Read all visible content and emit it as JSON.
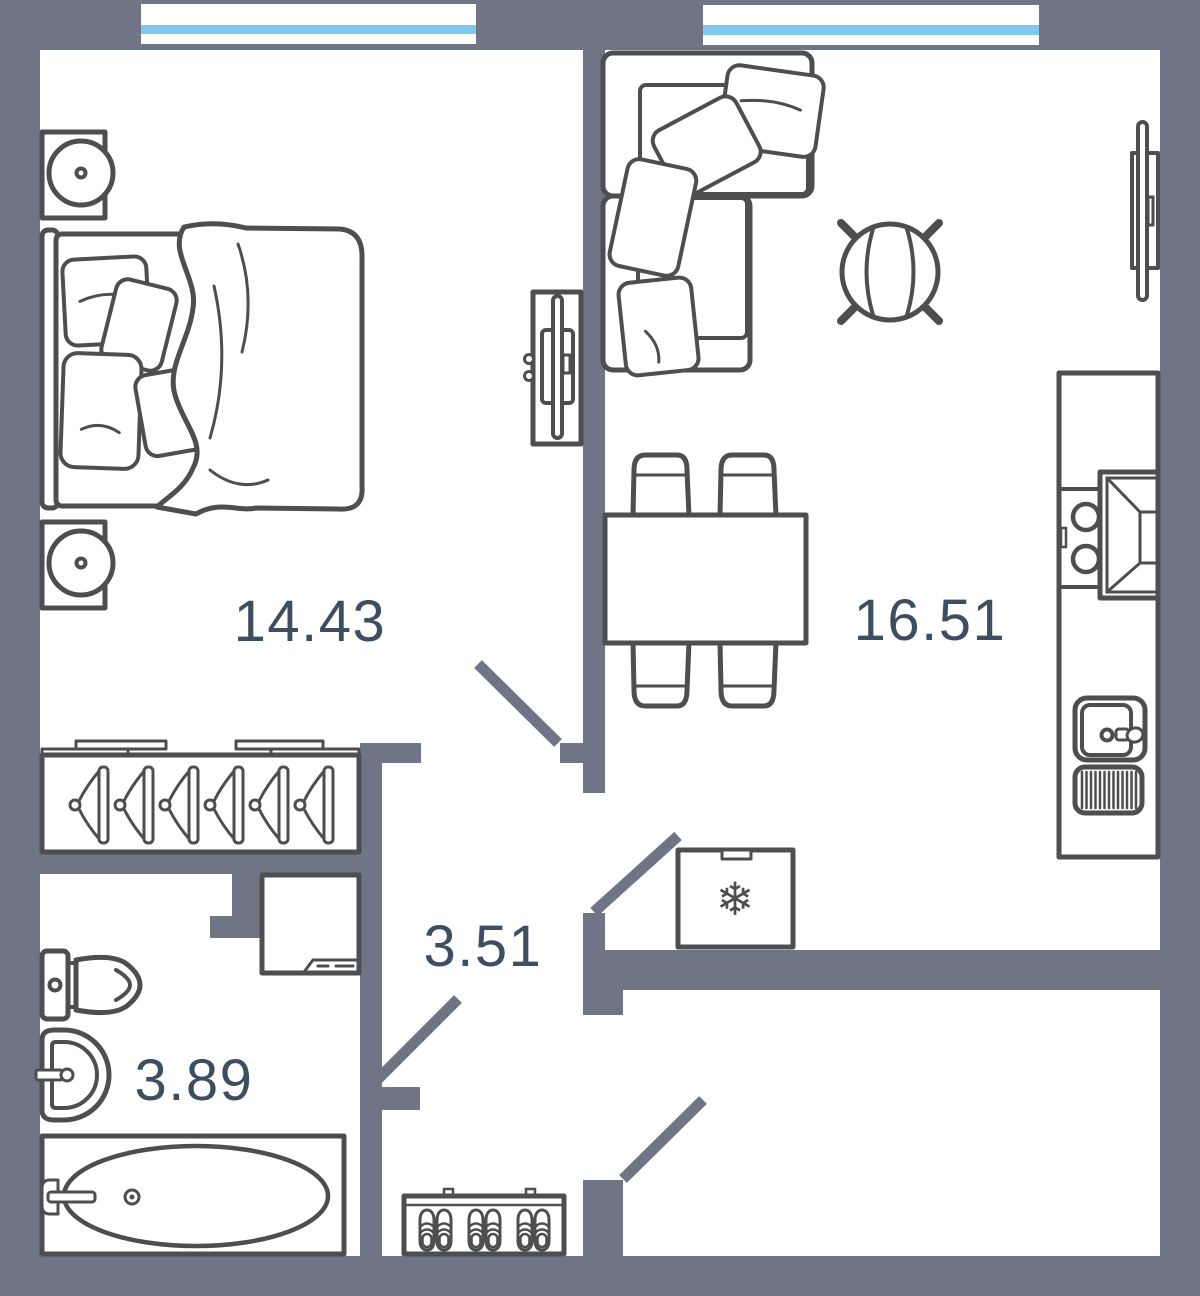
{
  "floorplan": {
    "rooms": [
      {
        "name": "bedroom",
        "area": "14.43"
      },
      {
        "name": "living-room-kitchen",
        "area": "16.51"
      },
      {
        "name": "hallway",
        "area": "3.51"
      },
      {
        "name": "bathroom",
        "area": "3.89"
      }
    ],
    "icons": {
      "fridge_snowflake": "❄"
    },
    "colors": {
      "wall": "#6f7585",
      "floor": "#ffffff",
      "furniture_outline": "#4d4e50",
      "room_label": "#3d4e61",
      "window_glass": "#7fcaec"
    }
  }
}
